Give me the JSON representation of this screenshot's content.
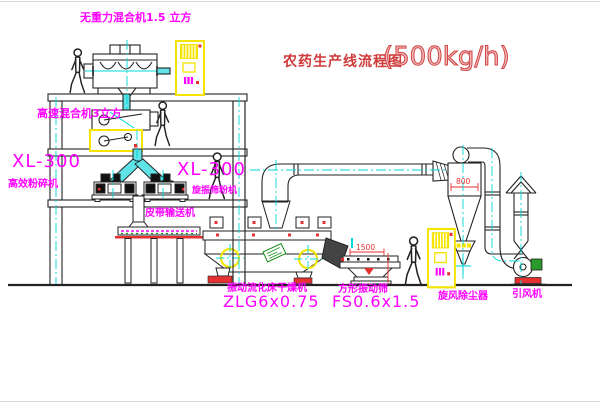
{
  "title": {
    "text": "农药生产线流程图",
    "capacity": "(500kg/h)"
  },
  "labels": {
    "gravity_mixer": "无重力混合机1.5 立方",
    "high_speed_mixer": "高速混合机3立方",
    "mill_left_model": "XL-300",
    "mill_left_name": "高效粉碎机",
    "mill_right_model": "XL-300",
    "mill_right_name": "旋振筛粉机",
    "belt_conveyor": "皮带输送机",
    "dryer_name": "振动流化床干燥机",
    "dryer_model": "ZLG6x0.75",
    "screen_name": "方形振动筛",
    "screen_model": "FS0.6x1.5",
    "cyclone": "旋风除尘器",
    "fan": "引风机"
  },
  "dimensions": {
    "screen_length": "1500",
    "cyclone_width": "800"
  },
  "colors": {
    "line": "#222222",
    "centerline_cyan": "#00d8d8",
    "pipe_fill_cyan": "#5fe3e6",
    "label_magenta": "#ff00ff",
    "title_red": "#cf3a3a",
    "cabinet_yellow": "#f5e400",
    "accent_red": "#e43232",
    "motor_green": "#2a9a2a"
  }
}
